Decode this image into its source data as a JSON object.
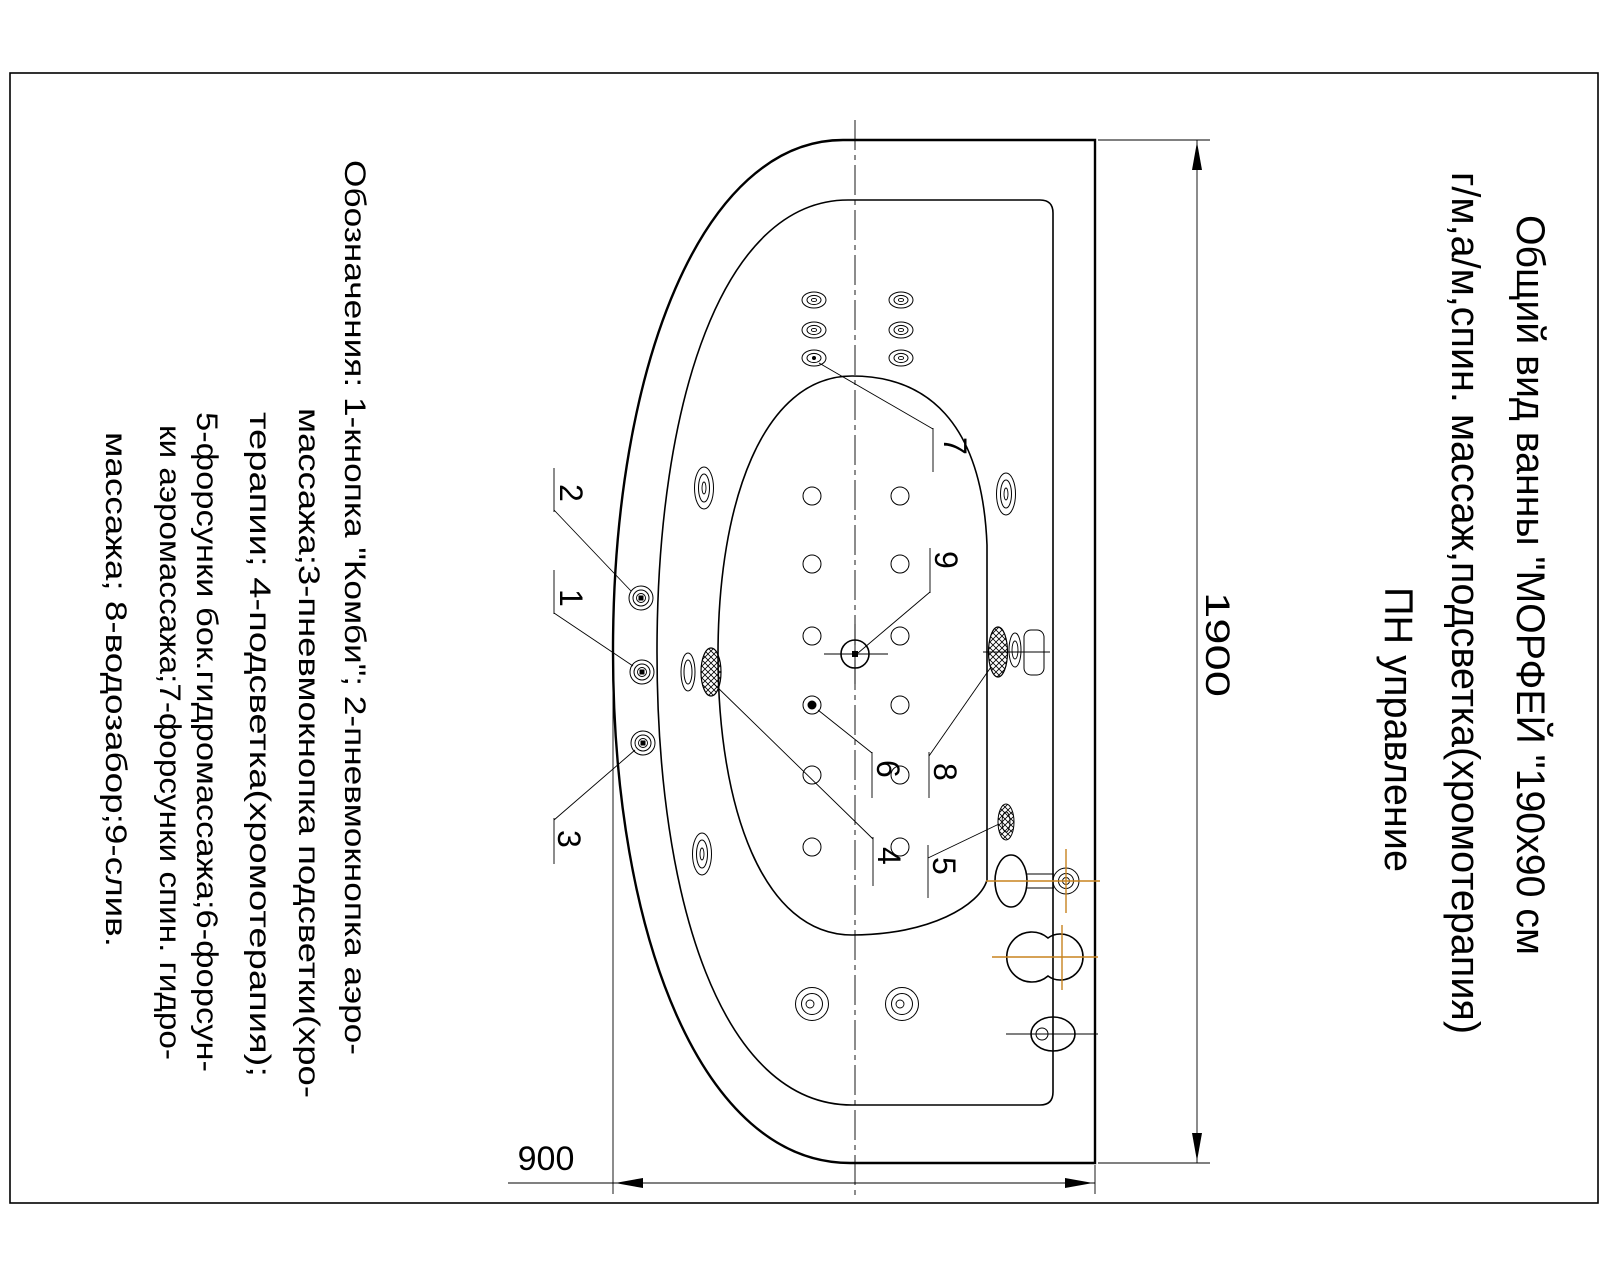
{
  "sheet": {
    "title_lines": [
      "Общий вид ванны \"МОРФЕЙ \"190х90 см",
      "г/м,а/м,спин. массаж,подсветка(хромотерапия)",
      "ПН управление"
    ],
    "legend_lines": [
      "Обозначения: 1-кнопка \"Комби\"; 2-пневмокнопка аэро-",
      "массажа;3-пневмокнопка подсветки(хро-",
      "терапии; 4-подсветка(хромотерапия);",
      "5-форсунки бок.гидромассажа;6-форсун-",
      "ки аэромассажа;7-форсунки спин. гидро-",
      "массажа; 8-водозабор;9-слив."
    ],
    "dimensions": {
      "length_mm": "1900",
      "width_mm": "900"
    },
    "callouts": [
      "1",
      "2",
      "3",
      "4",
      "5",
      "6",
      "7",
      "8",
      "9"
    ],
    "colors": {
      "ink": "#000000",
      "accent": "#c8831f",
      "paper": "#ffffff"
    }
  }
}
